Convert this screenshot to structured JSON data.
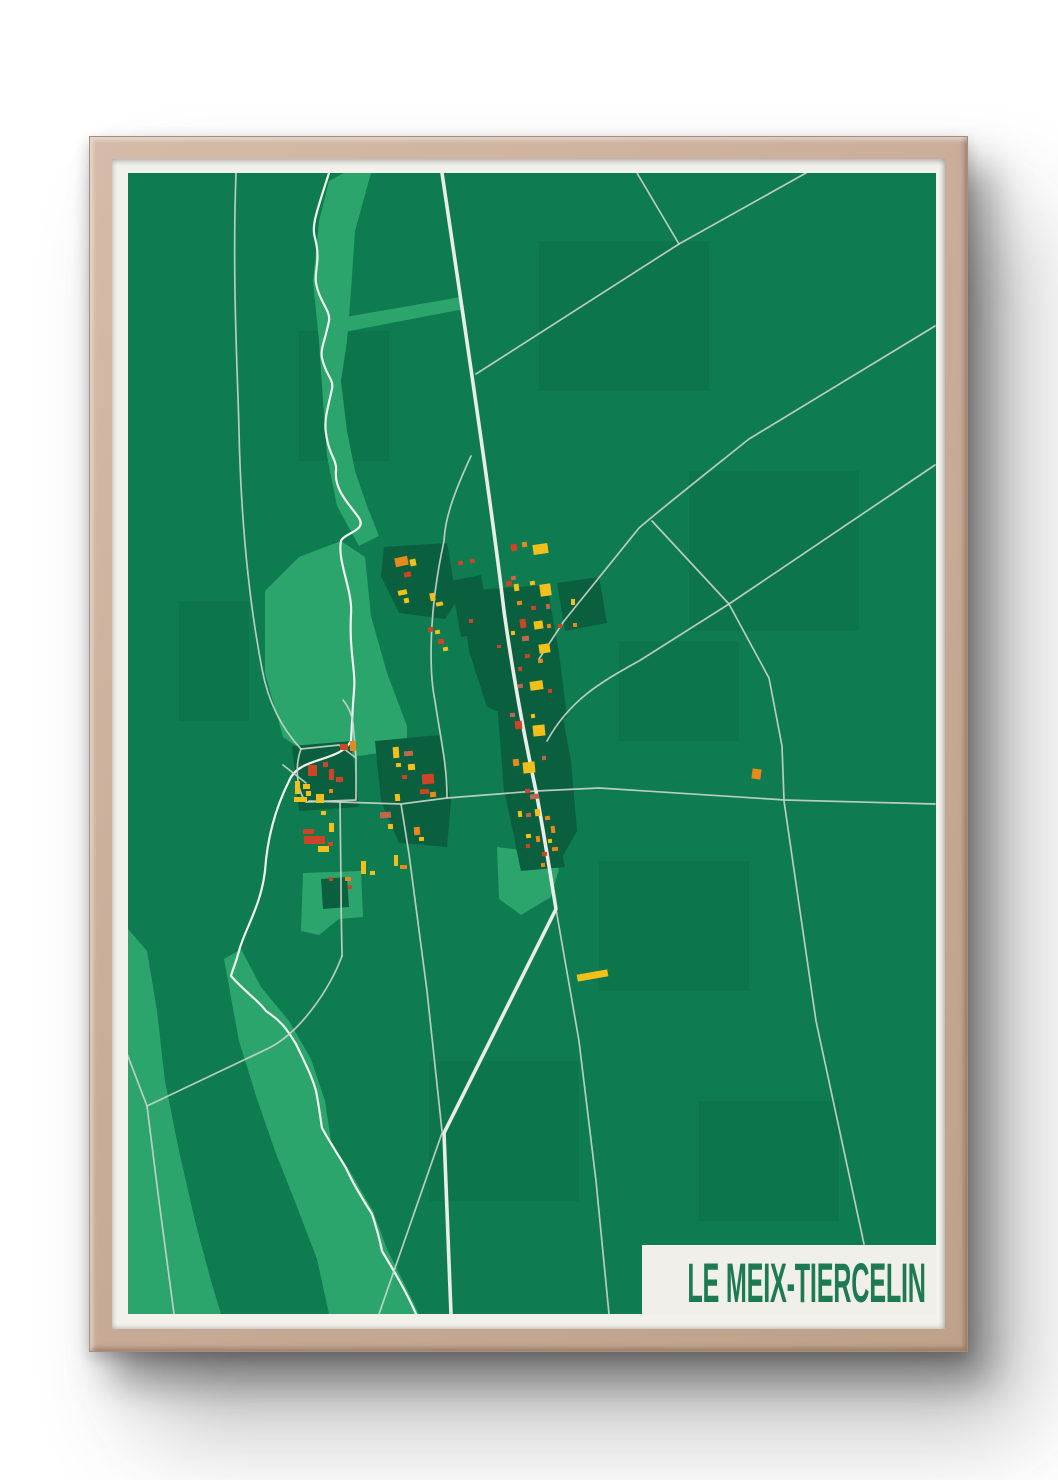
{
  "poster": {
    "title": "LE MEIX-TIERCELIN",
    "colors": {
      "page_background": "#ffffff",
      "frame_wood": "#c9ad99",
      "mat": "#f2f1ec",
      "map_green": "#0e7b50",
      "light_green": "#2ba56c",
      "dark_green": "#0a5f3e",
      "field_tint": "#0b6f47",
      "road_main": "#e9ece7",
      "road_thin": "#cbd5cc",
      "river": "#f2f4ef",
      "label_bg": "#f0efe9",
      "title_green": "#1e7a52",
      "red": "#ce4426",
      "orange": "#e78a1b",
      "yellow": "#f2bf1b",
      "salmon": "#c0664d"
    },
    "map": {
      "viewBox": "129 172 808 1141",
      "river": "M330,172 C318,210 312,225 316,237 C322,260 315,270 317,282 C320,300 332,310 330,320 C326,340 321,348 323,357 C327,375 335,378 333,388 C328,410 325,420 327,432 C330,455 338,458 337,470 C335,490 352,505 360,517 C368,530 345,532 342,540 C338,560 354,590 352,613 C350,650 357,670 355,690 C353,715 353,725 352,740 C340,762 300,755 290,780 C275,810 268,840 266,870 C262,905 245,930 240,950 C236,965 233,970 232,975 C245,990 260,1000 267,1010 C285,1022 290,1032 297,1043 C305,1060 313,1075 317,1090 C320,1105 321,1115 323,1127 C330,1140 340,1155 347,1167 C355,1185 365,1200 373,1213 C378,1228 381,1240 383,1250 C395,1270 408,1292 417,1313",
      "roads_main": [
        "M443,172 C465,320 492,500 505,610 C512,660 522,720 537,790 C546,838 552,878 557,908 L445,1132 L452,1313"
      ],
      "roads_thin": [
        "M237,172 C233,280 239,380 240,430 C242,520 250,600 263,668 C270,705 286,731 302,748",
        "M472,455 C452,498 446,520 445,540 C428,618 431,676 436,700 C441,735 448,762 448,797",
        "M638,172 L680,243",
        "M807,172 L680,243",
        "M680,243 L477,373",
        "M936,325 L750,438 C700,478 662,508 640,527 L565,620 L540,658",
        "M936,464 L730,603 L640,660 C600,682 570,700 548,740",
        "M653,520 L730,603 L770,677 L783,745 L785,798",
        "M310,800 L402,803 L448,797 L537,790 L600,787 L786,799 L936,803",
        "M785,800 L817,1020 L865,1243",
        "M402,803 L410,853 L428,990 L443,1130",
        "M302,748 C296,764 297,788 307,801 L357,799 L357,757 L340,744 L302,748",
        "M357,757 L354,722 C352,710 348,704 344,699",
        "M307,782 L284,764",
        "M341,801 L342,883 C342,925 343,940 343,955",
        "M148,1105 L270,1047 C300,1032 330,990 343,955",
        "M127,1050 L148,1105 L160,1200 L175,1313",
        "M443,1132 L380,1313",
        "M557,908 L580,1040 L597,1180 L610,1313"
      ],
      "light_patches": [
        "M345,172 L372,172 L356,230 L352,290 L348,340 L342,380 L348,430 L356,470 L368,505 L380,535 L360,545 L338,505 L328,455 L324,400 L320,340 L314,280 L320,220 L330,180 Z",
        "M335,318 L462,296 L465,308 L340,332 Z",
        "M266,590 L300,556 L342,540 L366,556 L372,615 L388,672 L408,725 L408,748 L360,755 L310,754 L284,736 L266,672 Z",
        "M304,872 L362,870 L364,916 L340,918 L320,934 L302,930 Z",
        "M498,846 L547,852 L560,868 L552,896 L522,914 L500,898 Z",
        "M225,958 L242,948 L262,986 L290,1020 L312,1058 L326,1100 L332,1140 L352,1172 L374,1210 L388,1248 L406,1284 L420,1313 L330,1313 L318,1258 L295,1198 L276,1150 L258,1098 L240,1040 Z",
        "M129,928 L148,950 L158,1010 L166,1080 L180,1150 L196,1220 L212,1280 L222,1313 L129,1313 Z"
      ],
      "dark_patches": [
        "M385,546 L448,542 L458,600 L446,618 L400,612 L382,575 Z",
        "M452,580 L482,574 L492,630 L462,636 Z",
        "M462,590 L548,584 L560,652 L568,716 L544,730 L488,706 L470,650 Z",
        "M498,700 L560,695 L572,760 L578,830 L560,862 L520,858 L505,790 Z",
        "M293,745 L352,740 L360,806 L300,810 Z",
        "M376,740 L440,734 L452,800 L448,846 L400,842 L382,800 Z",
        "M558,582 L600,576 L608,622 L566,630 Z",
        "M516,842 L560,838 L566,866 L522,870 Z",
        "M322,878 L348,876 L350,906 L324,908 Z"
      ],
      "field_tints": [
        [
          540,
          240,
          170,
          150
        ],
        [
          690,
          470,
          170,
          160
        ],
        [
          300,
          330,
          90,
          130
        ],
        [
          600,
          860,
          150,
          130
        ],
        [
          430,
          1060,
          150,
          140
        ],
        [
          700,
          1100,
          140,
          120
        ],
        [
          180,
          600,
          70,
          120
        ],
        [
          620,
          640,
          120,
          100
        ]
      ],
      "building_colors": {
        "R": "#ce4426",
        "O": "#e78a1b",
        "Y": "#f2bf1b",
        "S": "#c0664d"
      },
      "buildings": [
        [
          396,
          556,
          13,
          9,
          "O",
          -12
        ],
        [
          411,
          558,
          6,
          7,
          "Y",
          -12
        ],
        [
          405,
          571,
          7,
          5,
          "R",
          -12
        ],
        [
          399,
          589,
          9,
          5,
          "Y",
          -12
        ],
        [
          405,
          597,
          5,
          5,
          "Y",
          -12
        ],
        [
          431,
          592,
          5,
          8,
          "Y",
          -12
        ],
        [
          437,
          601,
          7,
          4,
          "Y",
          -12
        ],
        [
          459,
          560,
          5,
          4,
          "R",
          -12
        ],
        [
          471,
          558,
          5,
          4,
          "R",
          -12
        ],
        [
          429,
          626,
          5,
          5,
          "R",
          -10
        ],
        [
          436,
          629,
          5,
          4,
          "Y",
          -10
        ],
        [
          439,
          638,
          6,
          5,
          "R",
          -10
        ],
        [
          444,
          646,
          5,
          4,
          "Y",
          -10
        ],
        [
          470,
          618,
          4,
          4,
          "R",
          0
        ],
        [
          498,
          644,
          4,
          3,
          "R",
          0
        ],
        [
          512,
          543,
          6,
          7,
          "R",
          -8
        ],
        [
          523,
          541,
          5,
          5,
          "O",
          -8
        ],
        [
          534,
          543,
          15,
          10,
          "Y",
          -8
        ],
        [
          512,
          575,
          5,
          4,
          "S",
          -8
        ],
        [
          507,
          580,
          6,
          5,
          "R",
          -8
        ],
        [
          515,
          583,
          5,
          7,
          "Y",
          -8
        ],
        [
          531,
          580,
          5,
          4,
          "Y",
          -8
        ],
        [
          541,
          583,
          11,
          12,
          "Y",
          -8
        ],
        [
          518,
          600,
          5,
          4,
          "O",
          -8
        ],
        [
          532,
          605,
          5,
          4,
          "R",
          -8
        ],
        [
          547,
          603,
          4,
          5,
          "S",
          -8
        ],
        [
          521,
          618,
          6,
          9,
          "R",
          -8
        ],
        [
          535,
          620,
          9,
          8,
          "Y",
          -8
        ],
        [
          548,
          623,
          4,
          4,
          "O",
          -8
        ],
        [
          512,
          630,
          4,
          4,
          "Y",
          -8
        ],
        [
          523,
          635,
          7,
          5,
          "S",
          -8
        ],
        [
          540,
          643,
          11,
          9,
          "Y",
          -8
        ],
        [
          526,
          653,
          5,
          4,
          "R",
          -8
        ],
        [
          539,
          658,
          5,
          4,
          "O",
          -8
        ],
        [
          519,
          666,
          4,
          4,
          "R",
          -8
        ],
        [
          531,
          680,
          13,
          9,
          "Y",
          -8
        ],
        [
          519,
          683,
          5,
          4,
          "S",
          -8
        ],
        [
          549,
          688,
          4,
          4,
          "R",
          -8
        ],
        [
          572,
          598,
          4,
          6,
          "Y",
          0
        ],
        [
          574,
          622,
          4,
          4,
          "O",
          0
        ],
        [
          559,
          623,
          4,
          4,
          "R",
          0
        ],
        [
          511,
          712,
          5,
          4,
          "S",
          -6
        ],
        [
          516,
          720,
          7,
          8,
          "R",
          -6
        ],
        [
          534,
          724,
          12,
          11,
          "Y",
          -6
        ],
        [
          532,
          713,
          4,
          4,
          "Y",
          -6
        ],
        [
          514,
          758,
          6,
          7,
          "O",
          -6
        ],
        [
          524,
          761,
          12,
          11,
          "Y",
          -6
        ],
        [
          543,
          755,
          4,
          4,
          "S",
          -6
        ],
        [
          526,
          788,
          5,
          4,
          "R",
          -6
        ],
        [
          531,
          793,
          9,
          5,
          "S",
          -6
        ],
        [
          519,
          810,
          4,
          6,
          "Y",
          -6
        ],
        [
          527,
          812,
          5,
          4,
          "S",
          -6
        ],
        [
          536,
          808,
          5,
          7,
          "Y",
          -6
        ],
        [
          546,
          815,
          5,
          4,
          "O",
          -6
        ],
        [
          527,
          833,
          5,
          4,
          "Y",
          -6
        ],
        [
          537,
          835,
          4,
          6,
          "O",
          -6
        ],
        [
          549,
          838,
          4,
          4,
          "Y",
          -6
        ],
        [
          527,
          843,
          4,
          4,
          "R",
          -6
        ],
        [
          553,
          846,
          6,
          4,
          "O",
          -6
        ],
        [
          552,
          825,
          4,
          7,
          "O",
          -6
        ],
        [
          543,
          851,
          5,
          4,
          "R",
          -6
        ],
        [
          542,
          862,
          4,
          4,
          "O",
          -6
        ],
        [
          394,
          746,
          6,
          11,
          "Y",
          -4
        ],
        [
          405,
          750,
          9,
          5,
          "S",
          -4
        ],
        [
          397,
          762,
          5,
          4,
          "Y",
          -4
        ],
        [
          409,
          763,
          7,
          6,
          "Y",
          -4
        ],
        [
          403,
          774,
          5,
          4,
          "R",
          -4
        ],
        [
          423,
          773,
          12,
          10,
          "R",
          -4
        ],
        [
          421,
          788,
          9,
          5,
          "R",
          -4
        ],
        [
          431,
          791,
          6,
          5,
          "O",
          -4
        ],
        [
          396,
          793,
          5,
          7,
          "Y",
          -4
        ],
        [
          381,
          811,
          11,
          6,
          "S",
          -4
        ],
        [
          389,
          823,
          5,
          5,
          "Y",
          -4
        ],
        [
          415,
          826,
          6,
          8,
          "O",
          -4
        ],
        [
          420,
          836,
          5,
          4,
          "Y",
          -4
        ],
        [
          341,
          743,
          8,
          6,
          "R",
          0
        ],
        [
          351,
          740,
          6,
          10,
          "O",
          0
        ],
        [
          309,
          764,
          9,
          11,
          "R",
          0
        ],
        [
          324,
          761,
          5,
          5,
          "R",
          0
        ],
        [
          330,
          768,
          5,
          11,
          "R",
          0
        ],
        [
          337,
          776,
          7,
          5,
          "R",
          0
        ],
        [
          296,
          780,
          5,
          13,
          "Y",
          0
        ],
        [
          304,
          783,
          7,
          5,
          "Y",
          0
        ],
        [
          295,
          796,
          13,
          5,
          "Y",
          0
        ],
        [
          307,
          790,
          5,
          5,
          "Y",
          0
        ],
        [
          317,
          793,
          8,
          9,
          "Y",
          0
        ],
        [
          330,
          788,
          4,
          4,
          "O",
          0
        ],
        [
          322,
          810,
          5,
          4,
          "Y",
          0
        ],
        [
          330,
          822,
          5,
          9,
          "Y",
          0
        ],
        [
          304,
          828,
          11,
          5,
          "R",
          0
        ],
        [
          305,
          835,
          21,
          8,
          "R",
          0
        ],
        [
          329,
          841,
          5,
          4,
          "R",
          0
        ],
        [
          319,
          845,
          11,
          6,
          "Y",
          0
        ],
        [
          330,
          876,
          4,
          4,
          "R",
          0
        ],
        [
          362,
          860,
          5,
          13,
          "Y",
          0
        ],
        [
          371,
          870,
          5,
          4,
          "Y",
          0
        ],
        [
          346,
          876,
          6,
          4,
          "O",
          0
        ],
        [
          395,
          854,
          4,
          11,
          "Y",
          0
        ],
        [
          401,
          864,
          7,
          4,
          "O",
          0
        ],
        [
          349,
          884,
          4,
          4,
          "R",
          0
        ],
        [
          753,
          768,
          9,
          10,
          "O",
          8
        ],
        [
          578,
          971,
          31,
          7,
          "Y",
          -10
        ]
      ]
    }
  }
}
